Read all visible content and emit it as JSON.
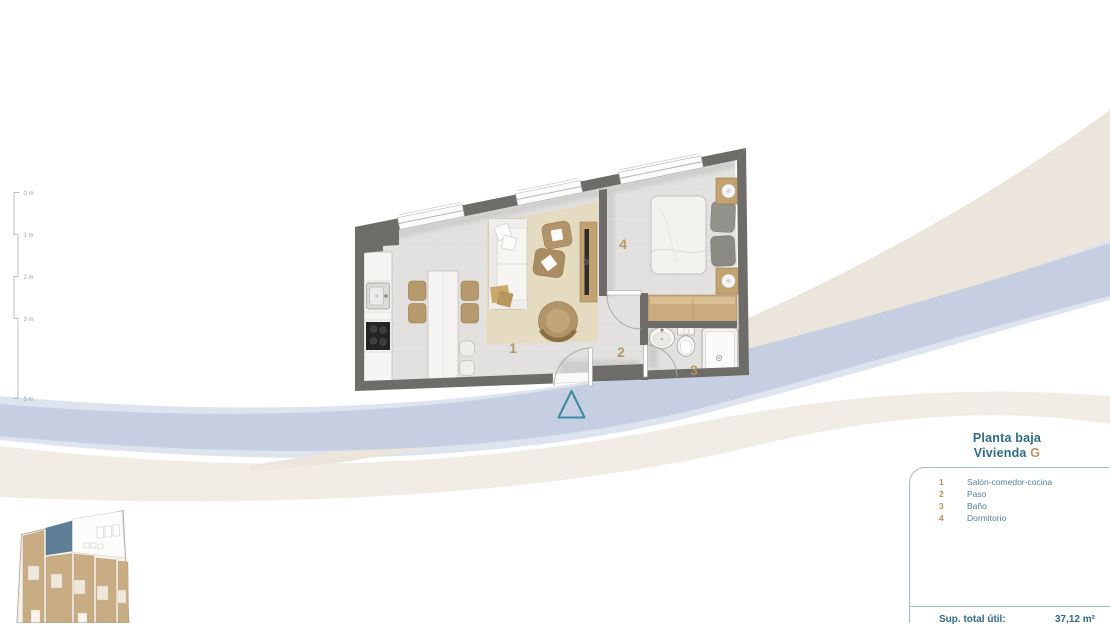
{
  "panel": {
    "title_line1": "Planta baja",
    "title_word": "Vivienda",
    "unit_letter": "G",
    "legend": [
      {
        "num": "1",
        "label": "Salón-comedor-cocina"
      },
      {
        "num": "2",
        "label": "Paso"
      },
      {
        "num": "3",
        "label": "Baño"
      },
      {
        "num": "4",
        "label": "Dormitorio"
      }
    ],
    "summary_label": "Sup. total útil:",
    "summary_value": "37,12 m²"
  },
  "plan": {
    "room_numbers": [
      "1",
      "2",
      "3",
      "4"
    ]
  },
  "scale_bar": {
    "labels": [
      "0 m",
      "1 m",
      "2 m",
      "3 m",
      "5 m"
    ]
  },
  "colors": {
    "swoosh_cream": "#ebe5db",
    "swoosh_cream_light": "#efe9e0",
    "swoosh_blue": "#c5cfe1",
    "swoosh_blue_light": "#dde4ef",
    "wall": "#6e6c69",
    "floor": "#e2e1df",
    "rug": "#e5dbc1",
    "wood": "#b1946a",
    "wood_light": "#c9ab7e",
    "entrance_triangle": "#3f88a2",
    "room_number": "#b5935b",
    "panel_border": "#a3b8cc",
    "title_blue": "#2d6b88",
    "highlight_unit_blue": "#5d7e95"
  }
}
